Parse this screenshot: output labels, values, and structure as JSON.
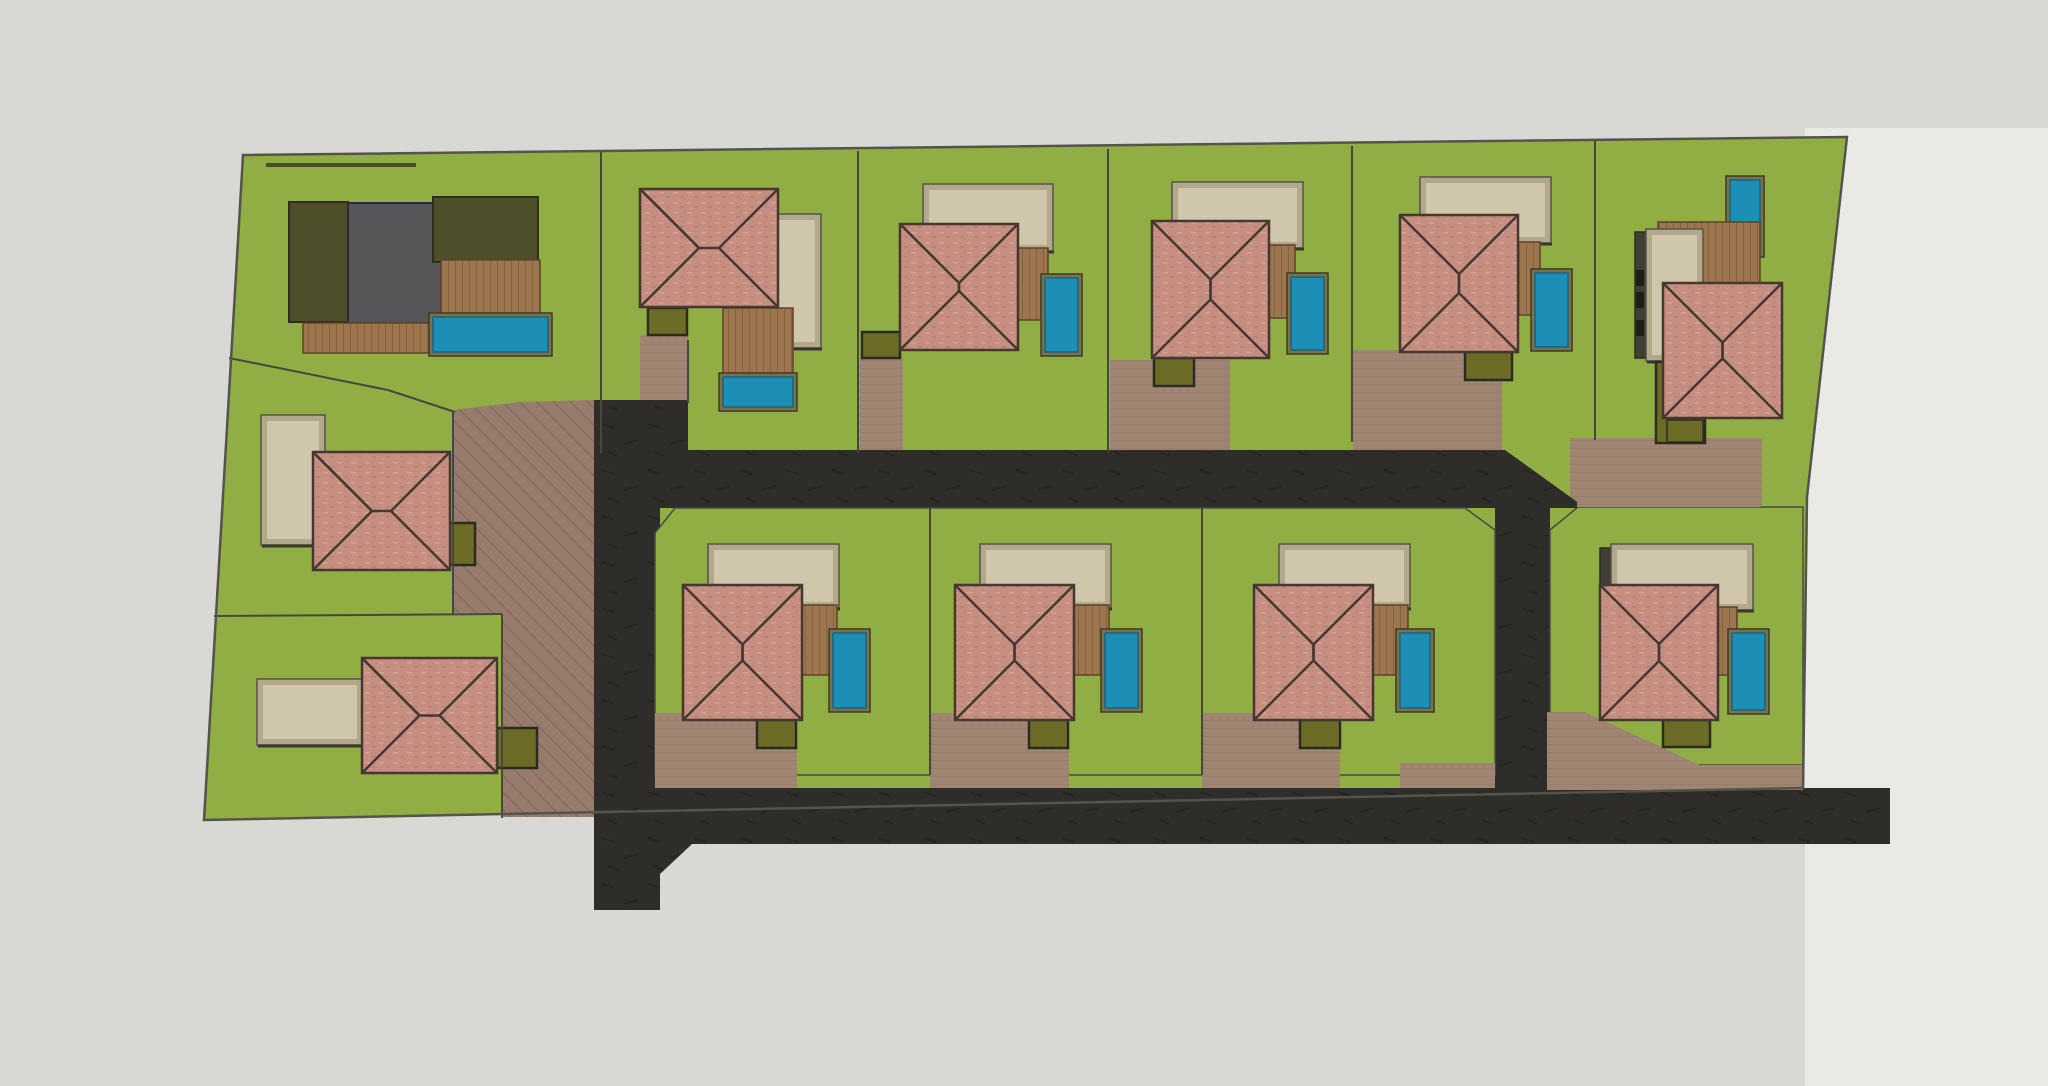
{
  "app": {
    "title": "Residential Subdivision Site Plan — Top View",
    "canvas": {
      "width": 2048,
      "height": 1086
    }
  },
  "colors": {
    "bg": "#d8d8d4",
    "bg_right": "#e9e9e6",
    "lawn": "#90ae44",
    "lawn_edge": "#4a4a42",
    "asphalt": "#2e2d2a",
    "paver": "#a08573",
    "paver_dark": "#977b6c",
    "roof": "#c58e80",
    "roof_line": "#463831",
    "cream": "#d0c6ab",
    "cream_frame": "#b2a88c",
    "cream_edge": "#56534a",
    "pool": "#1d8fb6",
    "pool_frame": "#7d7148",
    "deck": "#9d7650",
    "shed": "#6c6c27",
    "shed_edge": "#2b2b20",
    "house_gray": "#565659",
    "house_gray_edge": "#2c2c2e",
    "olive_dark": "#4e4e2a",
    "olive_edge": "#2e2e1e",
    "boundary": "#474740",
    "parcel_edge": "#55544b",
    "hedge": "#4b4b28",
    "window_dark": "#1e1e18",
    "column_dark": "#3f3f33"
  },
  "legend": {
    "lot_count": 14,
    "features": [
      "lawn",
      "hip-roof villa",
      "pool",
      "timber deck",
      "garden shed",
      "paver driveway",
      "asphalt road"
    ]
  },
  "shapes": [
    {
      "type": "rect",
      "name": "background-base",
      "x": 0,
      "y": 0,
      "w": 2048,
      "h": 1086,
      "fill": "bg"
    },
    {
      "type": "poly",
      "name": "background-right-panel",
      "points": "1805,128 2048,128 2048,1086 1805,1086",
      "fill": "bg_right"
    },
    {
      "type": "poly",
      "name": "parcel-lawn",
      "points": "243,155 1847,137 1807,497 1803,788 204,820",
      "fill": "lawn"
    },
    {
      "type": "poly",
      "name": "central-paver-area",
      "points": "453,410 520,402 594,400 594,817 502,817 502,613 453,613",
      "fill": "paverHatch"
    },
    {
      "type": "rect",
      "name": "lot-b-driveway",
      "x": 640,
      "y": 335,
      "w": 48,
      "h": 68,
      "fill": "paverTex"
    },
    {
      "type": "rect",
      "name": "lot-c-driveway",
      "x": 860,
      "y": 358,
      "w": 43,
      "h": 95,
      "fill": "paverTex"
    },
    {
      "type": "rect",
      "name": "lot-d-driveway",
      "x": 1110,
      "y": 360,
      "w": 120,
      "h": 92,
      "fill": "paverTex"
    },
    {
      "type": "rect",
      "name": "lot-e-driveway",
      "x": 1353,
      "y": 350,
      "w": 149,
      "h": 100,
      "fill": "paverTex"
    },
    {
      "type": "rect",
      "name": "lot-f-driveway",
      "x": 1570,
      "y": 438,
      "w": 192,
      "h": 67,
      "fill": "paverTex"
    },
    {
      "type": "poly",
      "name": "road-vertical-west",
      "points": "594,400 688,400 688,508 660,508 660,910 594,910",
      "fill": "roadTex"
    },
    {
      "type": "poly",
      "name": "road-upper-band",
      "points": "688,450 1505,450 1580,504 1580,508 688,508",
      "fill": "roadTex"
    },
    {
      "type": "poly",
      "name": "road-east-connector",
      "points": "1495,504 1550,504 1550,792 1495,792",
      "fill": "roadTex"
    },
    {
      "type": "poly",
      "name": "road-lower-band",
      "points": "660,788 1890,788 1890,844 660,844",
      "fill": "roadTex"
    },
    {
      "type": "poly",
      "name": "road-junction-flare-top",
      "points": "660,760 692,788 660,788",
      "fill": "roadTex"
    },
    {
      "type": "poly",
      "name": "road-junction-flare-bottom",
      "points": "660,844 692,844 660,874",
      "fill": "roadTex"
    },
    {
      "type": "poly",
      "name": "lot-j-lawn",
      "points": "675,508 930,508 930,775 655,775 655,533",
      "fill": "lawn",
      "stroke": "lawn_edge",
      "sw": 1.5
    },
    {
      "type": "poly",
      "name": "lot-k-lawn",
      "points": "930,508 1202,508 1202,775 930,775",
      "fill": "lawn",
      "stroke": "lawn_edge",
      "sw": 1.5
    },
    {
      "type": "poly",
      "name": "lot-l-lawn",
      "points": "1202,508 1465,508 1495,530 1495,775 1202,775",
      "fill": "lawn",
      "stroke": "lawn_edge",
      "sw": 1.5
    },
    {
      "type": "poly",
      "name": "lot-n-lawn",
      "points": "1578,507 1803,507 1803,765 1550,765 1550,530",
      "fill": "lawn",
      "stroke": "lawn_edge",
      "sw": 1.5
    },
    {
      "type": "rect",
      "name": "lot-j-driveway",
      "x": 655,
      "y": 713,
      "w": 142,
      "h": 75,
      "fill": "paverTex"
    },
    {
      "type": "rect",
      "name": "lot-k-driveway",
      "x": 930,
      "y": 713,
      "w": 139,
      "h": 75,
      "fill": "paverTex"
    },
    {
      "type": "rect",
      "name": "lot-l-driveway",
      "x": 1202,
      "y": 713,
      "w": 138,
      "h": 75,
      "fill": "paverTex"
    },
    {
      "type": "rect",
      "name": "lot-l-paver-strip",
      "x": 1400,
      "y": 763,
      "w": 95,
      "h": 25,
      "fill": "paverTex"
    },
    {
      "type": "poly",
      "name": "lot-n-paver-wedge",
      "points": "1547,712 1585,712 1700,765 1803,765 1803,790 1547,790",
      "fill": "paverTex"
    },
    {
      "type": "rect",
      "name": "lot-n-paver-top-strip",
      "x": 1577,
      "y": 480,
      "w": 183,
      "h": 27,
      "fill": "paverTex"
    },
    {
      "type": "rect",
      "name": "lot-a-hedge",
      "x": 266,
      "y": 163,
      "w": 150,
      "h": 4,
      "fill": "hedge"
    },
    {
      "type": "rect",
      "name": "lot-a-garage-wing",
      "x": 289,
      "y": 202,
      "w": 59,
      "h": 120,
      "fill": "olive_dark",
      "stroke": "olive_edge",
      "sw": 2
    },
    {
      "type": "rect",
      "name": "lot-a-flat-roof-house",
      "x": 348,
      "y": 203,
      "w": 94,
      "h": 122,
      "fill": "house_gray",
      "stroke": "house_gray_edge",
      "sw": 2
    },
    {
      "type": "rect",
      "name": "lot-a-rear-wing",
      "x": 433,
      "y": 197,
      "w": 105,
      "h": 65,
      "fill": "olive_dark",
      "stroke": "olive_edge",
      "sw": 2
    },
    {
      "type": "deck",
      "name": "lot-a-deck-south",
      "x": 303,
      "y": 323,
      "w": 130,
      "h": 30
    },
    {
      "type": "deck",
      "name": "lot-a-deck-east",
      "x": 441,
      "y": 260,
      "w": 99,
      "h": 57
    },
    {
      "type": "pool",
      "name": "lot-a-pool",
      "x": 433,
      "y": 317,
      "w": 115,
      "h": 35
    },
    {
      "type": "cream",
      "name": "lot-b-terrace",
      "x": 758,
      "y": 217,
      "w": 60,
      "h": 128
    },
    {
      "type": "deck",
      "name": "lot-b-deck",
      "x": 723,
      "y": 308,
      "w": 70,
      "h": 69
    },
    {
      "type": "pool",
      "name": "lot-b-pool",
      "x": 723,
      "y": 377,
      "w": 70,
      "h": 30
    },
    {
      "type": "shed",
      "name": "lot-b-shed",
      "x": 648,
      "y": 308,
      "w": 39,
      "h": 27
    },
    {
      "type": "roof",
      "name": "lot-b-roof",
      "x": 640,
      "y": 189,
      "w": 138,
      "h": 118
    },
    {
      "type": "cream",
      "name": "lot-c-terrace",
      "x": 926,
      "y": 187,
      "w": 124,
      "h": 61
    },
    {
      "type": "deck",
      "name": "lot-c-deck",
      "x": 1018,
      "y": 248,
      "w": 30,
      "h": 72
    },
    {
      "type": "pool",
      "name": "lot-c-pool",
      "x": 1045,
      "y": 278,
      "w": 33,
      "h": 74
    },
    {
      "type": "shed",
      "name": "lot-c-shed",
      "x": 862,
      "y": 332,
      "w": 38,
      "h": 26
    },
    {
      "type": "roof",
      "name": "lot-c-roof",
      "x": 900,
      "y": 224,
      "w": 118,
      "h": 126
    },
    {
      "type": "cream",
      "name": "lot-d-terrace",
      "x": 1175,
      "y": 185,
      "w": 125,
      "h": 60
    },
    {
      "type": "deck",
      "name": "lot-d-deck",
      "x": 1269,
      "y": 245,
      "w": 26,
      "h": 73
    },
    {
      "type": "pool",
      "name": "lot-d-pool",
      "x": 1291,
      "y": 277,
      "w": 33,
      "h": 73
    },
    {
      "type": "shed",
      "name": "lot-d-shed",
      "x": 1154,
      "y": 358,
      "w": 40,
      "h": 28
    },
    {
      "type": "roof",
      "name": "lot-d-roof",
      "x": 1152,
      "y": 221,
      "w": 117,
      "h": 137
    },
    {
      "type": "cream",
      "name": "lot-e-terrace",
      "x": 1423,
      "y": 180,
      "w": 125,
      "h": 60
    },
    {
      "type": "deck",
      "name": "lot-e-deck",
      "x": 1518,
      "y": 242,
      "w": 22,
      "h": 73
    },
    {
      "type": "pool",
      "name": "lot-e-pool",
      "x": 1535,
      "y": 273,
      "w": 33,
      "h": 74
    },
    {
      "type": "shed",
      "name": "lot-e-shed",
      "x": 1465,
      "y": 352,
      "w": 47,
      "h": 28
    },
    {
      "type": "roof",
      "name": "lot-e-roof",
      "x": 1400,
      "y": 215,
      "w": 118,
      "h": 137
    },
    {
      "type": "pool",
      "name": "lot-f-pool",
      "x": 1730,
      "y": 180,
      "w": 30,
      "h": 73
    },
    {
      "type": "deck",
      "name": "lot-f-deck",
      "x": 1658,
      "y": 222,
      "w": 102,
      "h": 61
    },
    {
      "type": "rect",
      "name": "lot-f-house-column",
      "x": 1635,
      "y": 232,
      "w": 14,
      "h": 126,
      "fill": "column_dark",
      "stroke": "olive_edge",
      "sw": 1.5
    },
    {
      "type": "cream",
      "name": "lot-f-terrace",
      "x": 1649,
      "y": 232,
      "w": 51,
      "h": 126
    },
    {
      "type": "rect",
      "name": "lot-f-window-1",
      "x": 1636,
      "y": 270,
      "w": 8,
      "h": 16,
      "fill": "window_dark"
    },
    {
      "type": "rect",
      "name": "lot-f-window-2",
      "x": 1636,
      "y": 292,
      "w": 8,
      "h": 16,
      "fill": "window_dark"
    },
    {
      "type": "rect",
      "name": "lot-f-window-3",
      "x": 1636,
      "y": 320,
      "w": 8,
      "h": 16,
      "fill": "window_dark"
    },
    {
      "type": "shed",
      "name": "lot-f-shed",
      "x": 1656,
      "y": 362,
      "w": 49,
      "h": 81
    },
    {
      "type": "rect",
      "name": "lot-f-shed-inner",
      "x": 1667,
      "y": 420,
      "w": 36,
      "h": 22,
      "fill": "shed",
      "stroke": "shed_edge",
      "sw": 1.5
    },
    {
      "type": "roof",
      "name": "lot-f-roof",
      "x": 1663,
      "y": 283,
      "w": 119,
      "h": 135
    },
    {
      "type": "cream",
      "name": "lot-g-terrace",
      "x": 264,
      "y": 418,
      "w": 58,
      "h": 124
    },
    {
      "type": "shed",
      "name": "lot-g-shed",
      "x": 448,
      "y": 523,
      "w": 27,
      "h": 42
    },
    {
      "type": "roof",
      "name": "lot-g-roof",
      "x": 313,
      "y": 452,
      "w": 137,
      "h": 118
    },
    {
      "type": "cream",
      "name": "lot-h-terrace",
      "x": 260,
      "y": 682,
      "w": 100,
      "h": 60
    },
    {
      "type": "shed",
      "name": "lot-h-shed",
      "x": 497,
      "y": 728,
      "w": 40,
      "h": 40
    },
    {
      "type": "roof",
      "name": "lot-h-roof",
      "x": 362,
      "y": 658,
      "w": 135,
      "h": 115
    },
    {
      "type": "cream",
      "name": "lot-j-terrace",
      "x": 711,
      "y": 547,
      "w": 125,
      "h": 58
    },
    {
      "type": "deck",
      "name": "lot-j-deck",
      "x": 802,
      "y": 605,
      "w": 35,
      "h": 70
    },
    {
      "type": "pool",
      "name": "lot-j-pool",
      "x": 833,
      "y": 633,
      "w": 33,
      "h": 75
    },
    {
      "type": "shed",
      "name": "lot-j-shed",
      "x": 757,
      "y": 720,
      "w": 39,
      "h": 28
    },
    {
      "type": "roof",
      "name": "lot-j-roof",
      "x": 683,
      "y": 585,
      "w": 119,
      "h": 135
    },
    {
      "type": "cream",
      "name": "lot-k-terrace",
      "x": 983,
      "y": 547,
      "w": 125,
      "h": 58
    },
    {
      "type": "deck",
      "name": "lot-k-deck",
      "x": 1074,
      "y": 605,
      "w": 35,
      "h": 70
    },
    {
      "type": "pool",
      "name": "lot-k-pool",
      "x": 1105,
      "y": 633,
      "w": 33,
      "h": 75
    },
    {
      "type": "shed",
      "name": "lot-k-shed",
      "x": 1029,
      "y": 720,
      "w": 39,
      "h": 28
    },
    {
      "type": "roof",
      "name": "lot-k-roof",
      "x": 955,
      "y": 585,
      "w": 119,
      "h": 135
    },
    {
      "type": "cream",
      "name": "lot-l-terrace",
      "x": 1282,
      "y": 547,
      "w": 125,
      "h": 58
    },
    {
      "type": "deck",
      "name": "lot-l-deck",
      "x": 1373,
      "y": 605,
      "w": 35,
      "h": 70
    },
    {
      "type": "pool",
      "name": "lot-l-pool",
      "x": 1400,
      "y": 633,
      "w": 30,
      "h": 75
    },
    {
      "type": "shed",
      "name": "lot-l-shed",
      "x": 1300,
      "y": 720,
      "w": 40,
      "h": 28
    },
    {
      "type": "roof",
      "name": "lot-l-roof",
      "x": 1254,
      "y": 585,
      "w": 119,
      "h": 135
    },
    {
      "type": "rect",
      "name": "lot-n-house-column",
      "x": 1600,
      "y": 548,
      "w": 14,
      "h": 142,
      "fill": "column_dark",
      "stroke": "olive_edge",
      "sw": 1.5
    },
    {
      "type": "cream",
      "name": "lot-n-terrace",
      "x": 1614,
      "y": 547,
      "w": 136,
      "h": 60
    },
    {
      "type": "deck",
      "name": "lot-n-deck",
      "x": 1718,
      "y": 607,
      "w": 19,
      "h": 68
    },
    {
      "type": "pool",
      "name": "lot-n-pool",
      "x": 1732,
      "y": 633,
      "w": 33,
      "h": 77
    },
    {
      "type": "shed",
      "name": "lot-n-shed",
      "x": 1663,
      "y": 720,
      "w": 47,
      "h": 27
    },
    {
      "type": "roof",
      "name": "lot-n-roof",
      "x": 1600,
      "y": 585,
      "w": 118,
      "h": 135
    },
    {
      "type": "line",
      "name": "boundary-lot-a-b",
      "x1": 601,
      "y1": 152,
      "x2": 601,
      "y2": 453
    },
    {
      "type": "line",
      "name": "boundary-lot-b-c",
      "x1": 858,
      "y1": 151,
      "x2": 858,
      "y2": 453
    },
    {
      "type": "line",
      "name": "boundary-lot-c-d",
      "x1": 1108,
      "y1": 149,
      "x2": 1108,
      "y2": 452
    },
    {
      "type": "line",
      "name": "boundary-lot-d-e",
      "x1": 1352,
      "y1": 146,
      "x2": 1352,
      "y2": 442
    },
    {
      "type": "line",
      "name": "boundary-lot-e-f",
      "x1": 1595,
      "y1": 141,
      "x2": 1595,
      "y2": 440
    },
    {
      "type": "line",
      "name": "boundary-lot-a-g-1",
      "x1": 229,
      "y1": 358,
      "x2": 388,
      "y2": 390
    },
    {
      "type": "line",
      "name": "boundary-lot-a-g-2",
      "x1": 388,
      "y1": 390,
      "x2": 455,
      "y2": 412
    },
    {
      "type": "line",
      "name": "boundary-lot-g-h",
      "x1": 214,
      "y1": 616,
      "x2": 502,
      "y2": 614
    },
    {
      "type": "line",
      "name": "boundary-lot-g-east",
      "x1": 453,
      "y1": 412,
      "x2": 453,
      "y2": 614
    },
    {
      "type": "line",
      "name": "boundary-lot-h-east",
      "x1": 502,
      "y1": 614,
      "x2": 502,
      "y2": 818
    },
    {
      "type": "line",
      "name": "boundary-lot-j-k",
      "x1": 930,
      "y1": 508,
      "x2": 930,
      "y2": 775
    },
    {
      "type": "line",
      "name": "boundary-lot-k-l",
      "x1": 1202,
      "y1": 508,
      "x2": 1202,
      "y2": 775
    },
    {
      "type": "line",
      "name": "boundary-lot-b-drive",
      "x1": 688,
      "y1": 340,
      "x2": 688,
      "y2": 403
    },
    {
      "type": "poly",
      "name": "parcel-outline",
      "points": "243,155 1847,137 1807,497 1803,788 204,820",
      "fill": "none",
      "stroke": "parcel_edge",
      "sw": 2.5
    }
  ]
}
